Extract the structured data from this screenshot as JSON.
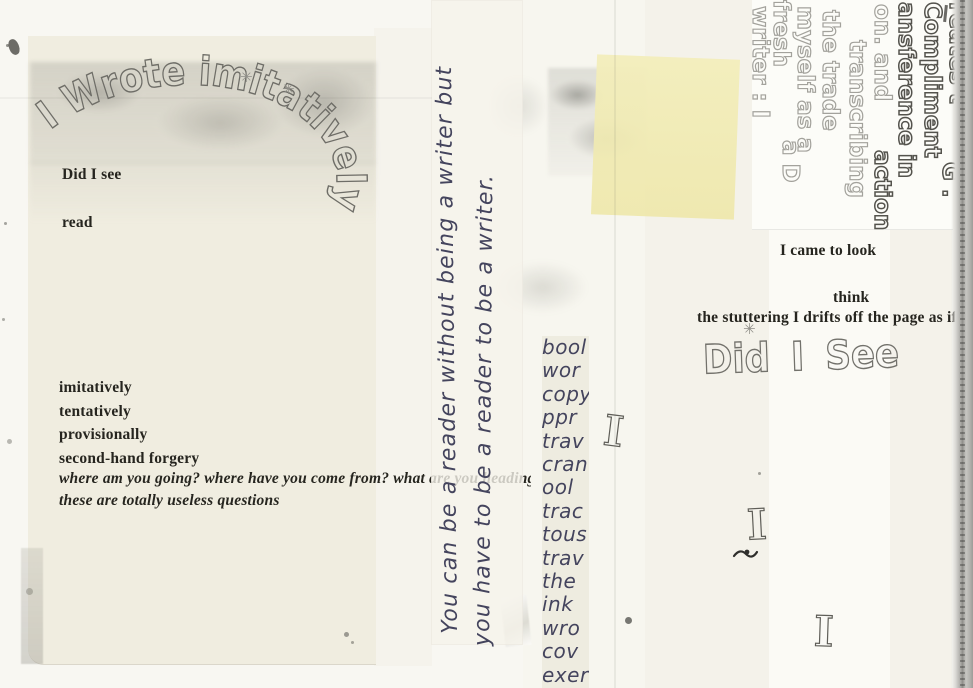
{
  "page": {
    "bubble_title": "I Wrote imitatively",
    "left_sheet": {
      "did_i_see": "Did I see",
      "read": "read",
      "adverbs": [
        "imitatively",
        "tentatively",
        "provisionally",
        "second-hand forgery"
      ],
      "question_line": "where am you going? where have you come from? what are you heading for?",
      "answer_line": "these are totally useless questions"
    },
    "tape_strip": {
      "line1": "You can be a reader without being a writer but",
      "line2": "you have to be a reader to be a writer."
    },
    "word_column": [
      "bool",
      "wor",
      "copy",
      "ppr",
      "trav",
      "cran",
      "ool",
      "trac",
      "tous",
      "trav",
      "the",
      "ink",
      "wro",
      "cov",
      "exer"
    ],
    "right_column": {
      "came_to_look": "I came to look",
      "think": "think",
      "stuttering": "the stuttering I drifts off the page as if",
      "bubble_did_i_see": "Did I See"
    },
    "rotated_block": {
      "lines": [
        "reates t",
        "Compliment",
        "ansference in",
        "on. and",
        "action",
        "transcribing",
        "the trade",
        "myself as a",
        "fresh",
        "writer : I",
        "a D",
        "G ."
      ]
    },
    "glyphs": {
      "bubble_i": "I",
      "asterisk": "✳"
    },
    "colors": {
      "ink": "#45455e",
      "typed": "#26251f",
      "bubble_grey": "#a3a29c",
      "bubble_dark": "#54534d",
      "sticky": "#f1ecb4"
    }
  }
}
